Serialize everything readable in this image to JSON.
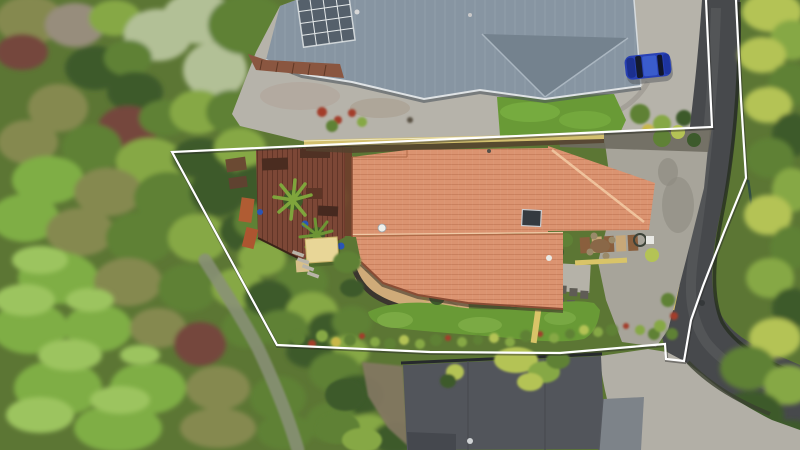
{
  "scene": {
    "kind": "aerial-drone-photo",
    "subject": "residential property with white cadastral boundary overlay",
    "labels": {
      "subject_house": "subject-house-terracotta-roof",
      "upper_neighbor": "neighbor-house-north-gray-roof",
      "lower_neighbor": "neighbor-house-south-dark-roof",
      "road": "curving-asphalt-road",
      "hedge": "roadside-hedge",
      "car": "parked-blue-car",
      "boundary": "property-boundary-outline"
    }
  },
  "palette": {
    "boundary_stroke": "#ffffff",
    "boundary_shadow": "rgba(40,40,40,0.45)",
    "subject_roof": "#db9370",
    "subject_roof_ridge": "#efc29c",
    "neighbor_top_roof": "#8795a2",
    "neighbor_top_gable": "#74828e",
    "conservatory": "#55606b",
    "neighbor_bottom_roof": "#52555b",
    "neighbor_bottom_wing": "#7d8389",
    "road": "#47494c",
    "road_worn": "#5c5e60",
    "concrete_upper": "#b6b3aa",
    "concrete_court": "#a7a49a",
    "concrete_lower": "#b2afa6",
    "lawn": "#699a36",
    "grass": "#7fae45",
    "deck": "#7c4736",
    "cream_wall": "#d2bf6e",
    "shade_sail": "#e8d697",
    "car": "#2841b4",
    "car_roof": "#3a5ccc",
    "paving": "#cfab79",
    "skylight": "#343a40",
    "soil": "#857863",
    "path": "#8a9179",
    "kerb_yellow": "#d9c468",
    "base_vegetation": "#5c7634"
  },
  "boundary": {
    "outline_points": "706,0 712,127 604,132 172,152 277,345 430,352 560,353 665,344 666,359 684,361 691,320 703,286 724,232 746,178 741,100 736,0"
  }
}
